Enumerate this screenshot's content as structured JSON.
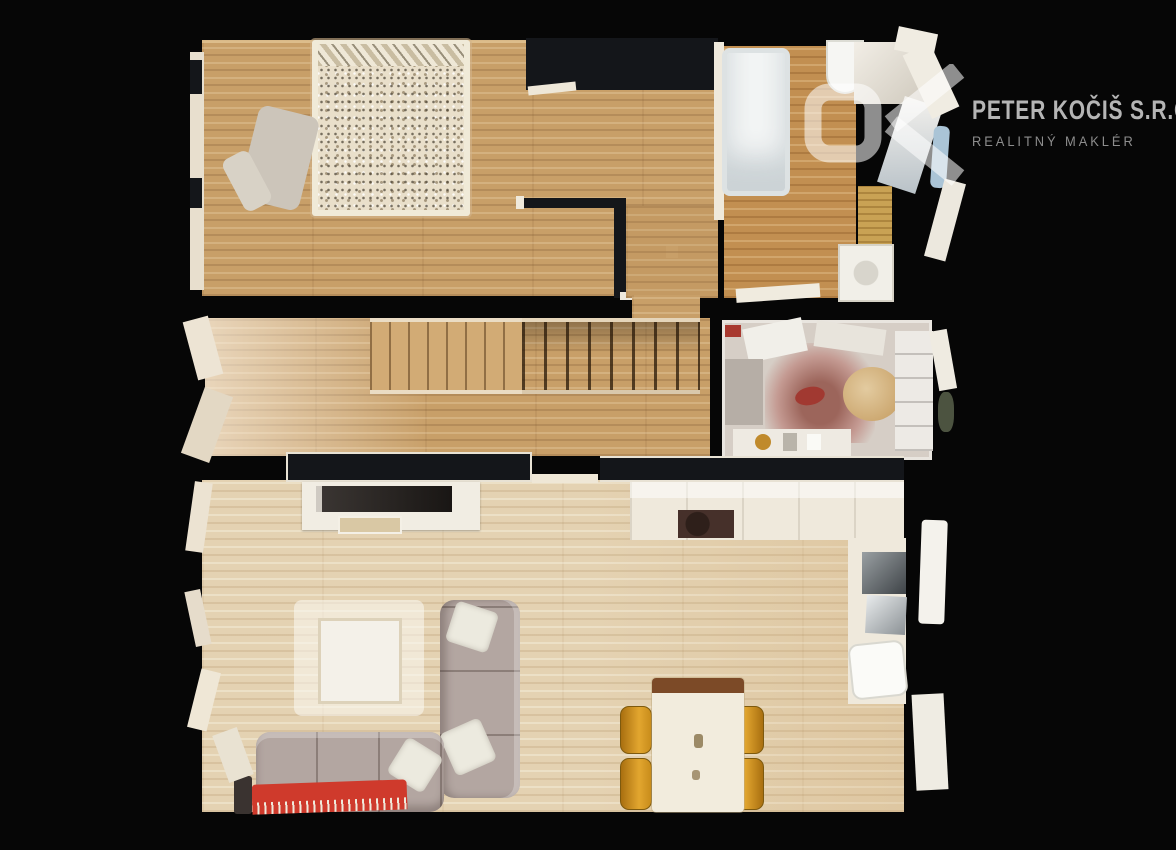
{
  "brand": {
    "monogram": "DK",
    "name": "PETER KOČIŠ S.R.O.",
    "tagline": "REALITNÝ MAKLÉR"
  },
  "colors": {
    "background": "#060606",
    "wall_dark": "#14161a",
    "wood_warm": "#c89f68",
    "wood_bath": "#c28f51",
    "wood_pale": "#e4d2b2",
    "sofa": "#b3a6a1",
    "blanket_red": "#cf3a2c",
    "chair_amber": "#d79a25",
    "table_cream": "#f2ecdd",
    "tub_white": "#f3f5f5",
    "logo_mark": "rgba(255,255,255,0.55)",
    "logo_name": "#b5b5b5",
    "logo_tagline": "#8d8d8d"
  }
}
